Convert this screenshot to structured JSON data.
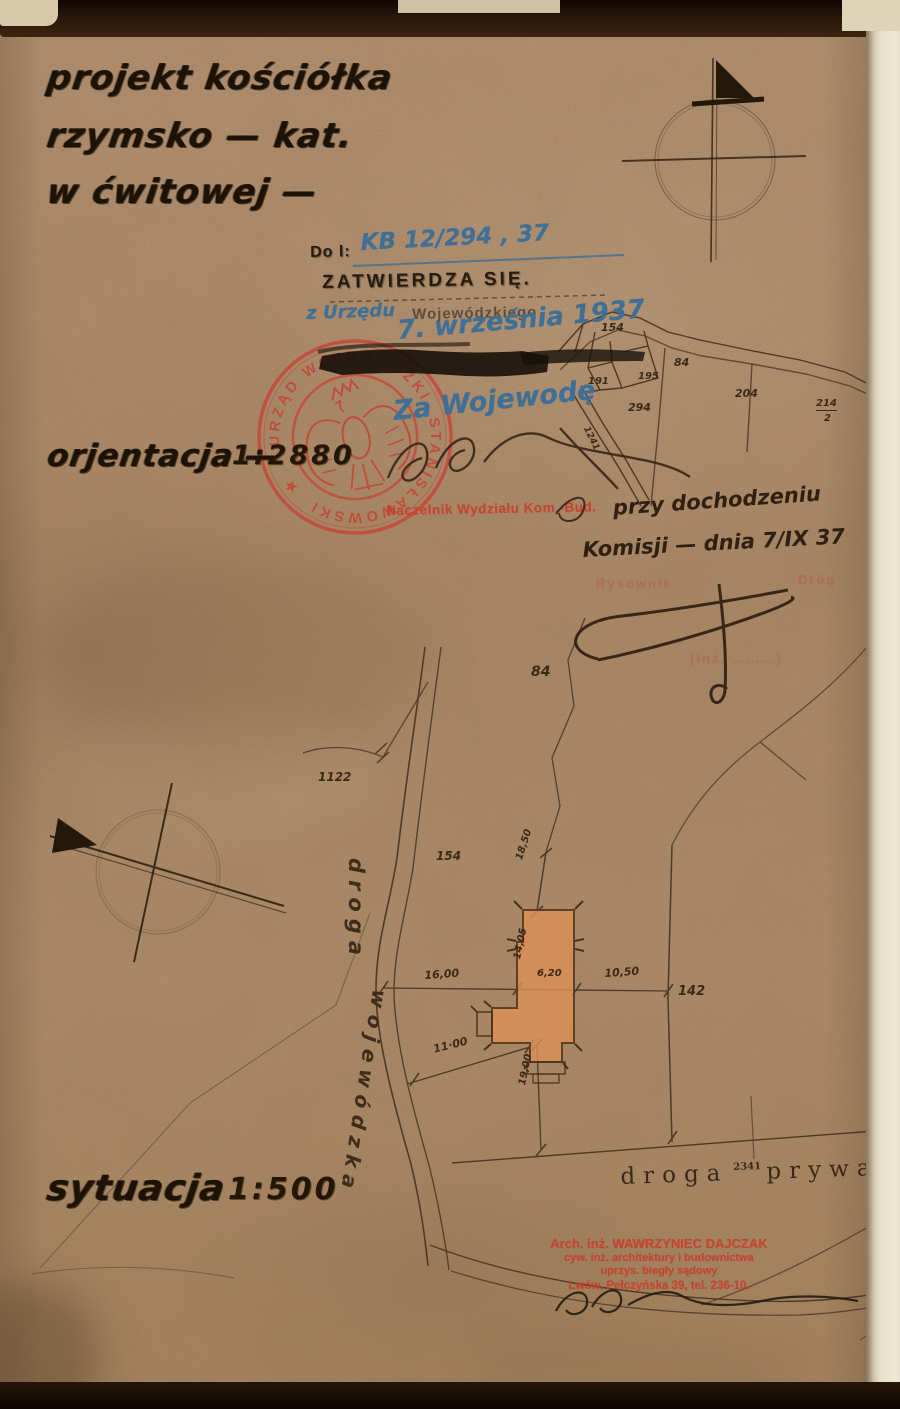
{
  "header": {
    "title_line1": "projekt kościółka",
    "title_line2": "rzymsko — kat.",
    "title_line3": "w ćwitowej —"
  },
  "approval": {
    "ref_label": "Do l:",
    "ref_number": "KB 12/294 , 37",
    "stamp_text": "ZATWIERDZA SIĘ.",
    "hand_prefix": "z Urzędu",
    "stamp_suffix": "Wojewódzkiego",
    "hand_date": "7. września 1937",
    "za_wojewode": "Za Wojewodę",
    "naczelnik_stamp": "Naczelnik Wydziału Kom.-Bud.",
    "seal_text_top": "URZĄD WOJEWÓDZKI",
    "seal_text_bottom": "STANISŁAWOWSKI",
    "seal_star": "★"
  },
  "notes": {
    "hand_line1": "przy dochodzeniu",
    "hand_line2": "Komisji — dnia 7/IX 37",
    "faint_stamp_left": "Rysownik",
    "faint_stamp_right": "Dróg",
    "faint_stamp_paren": "(Inż. ………)"
  },
  "orientation_map": {
    "label": "orjentacja —",
    "scale": "1:2880",
    "parcel_labels": [
      {
        "t": "154",
        "x": 601,
        "y": 321,
        "fs": 11
      },
      {
        "t": "84",
        "x": 674,
        "y": 356,
        "fs": 11
      },
      {
        "t": "191",
        "x": 588,
        "y": 376,
        "fs": 10
      },
      {
        "t": "195",
        "x": 638,
        "y": 371,
        "fs": 10
      },
      {
        "t": "294",
        "x": 628,
        "y": 401,
        "fs": 11
      },
      {
        "t": "204",
        "x": 735,
        "y": 387,
        "fs": 11
      },
      {
        "t": "214",
        "x": 816,
        "y": 398,
        "fs": 10,
        "cls": "underl"
      },
      {
        "t": "2",
        "x": 824,
        "y": 413,
        "fs": 10
      },
      {
        "t": "1241",
        "x": 590,
        "y": 425,
        "fs": 9,
        "rot": 64
      }
    ]
  },
  "site_plan": {
    "label": "sytuacja",
    "scale": "1:500",
    "road_west_line1": "droga",
    "road_west_line2": "wojewódzka",
    "road_south_word1": "droga",
    "road_south_number": "2341",
    "road_south_word2": "prywatna",
    "labels": [
      {
        "t": "84",
        "x": 531,
        "y": 664,
        "fs": 14
      },
      {
        "t": "1122",
        "x": 318,
        "y": 770,
        "fs": 12
      },
      {
        "t": "154",
        "x": 436,
        "y": 849,
        "fs": 12
      },
      {
        "t": "142",
        "x": 678,
        "y": 984,
        "fs": 13
      },
      {
        "t": "16,00",
        "x": 424,
        "y": 969,
        "fs": 11,
        "rot": -4
      },
      {
        "t": "14,05",
        "x": 512,
        "y": 958,
        "fs": 10,
        "rot": -78
      },
      {
        "t": "6,20",
        "x": 537,
        "y": 968,
        "fs": 10
      },
      {
        "t": "10,50",
        "x": 604,
        "y": 967,
        "fs": 11,
        "rot": -4
      },
      {
        "t": "18,50",
        "x": 514,
        "y": 858,
        "fs": 10,
        "rot": -72
      },
      {
        "t": "11·00",
        "x": 432,
        "y": 1043,
        "fs": 11,
        "rot": -14
      },
      {
        "t": "19,00",
        "x": 517,
        "y": 1084,
        "fs": 10,
        "rot": -78
      }
    ]
  },
  "architect_stamp": {
    "line1": "Arch. inż. WAWRZYNIEC DAJCZAK",
    "line2": "cyw. inż. architektury i budownictwa",
    "line3": "uprzys. biegły sądowy",
    "line4": "Lwów, Pełczyńska 39, tel. 236-10."
  },
  "colors": {
    "paper": "#b18e6d",
    "ink_black": "#221708",
    "ink_sepia": "#3f2c18",
    "hand_blue": "#3e6f96",
    "stamp_red": "#c54434",
    "building_fill": "#dd9056",
    "canvas_cream": "#e7dec6"
  }
}
